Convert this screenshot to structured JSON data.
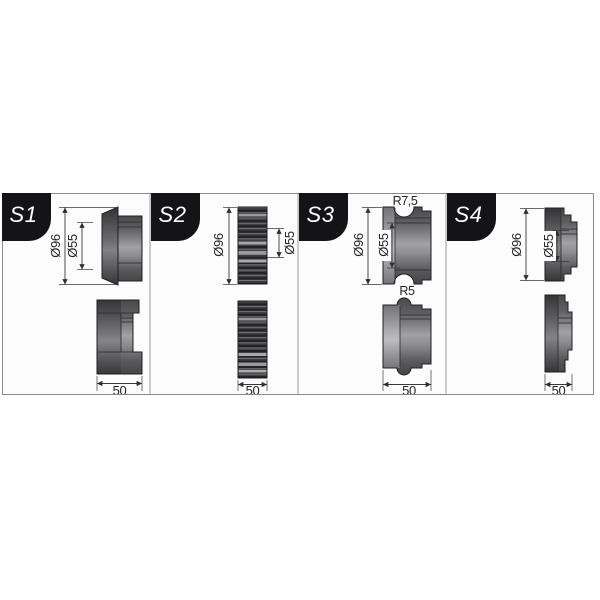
{
  "diagram_title": "roller-die-profiles",
  "panels": [
    {
      "id": "s1",
      "label": "S1",
      "dims": {
        "outer": "Ø96",
        "bore": "Ø55",
        "width": "50"
      }
    },
    {
      "id": "s2",
      "label": "S2",
      "dims": {
        "outer": "Ø96",
        "bore": "Ø55",
        "width": "50"
      }
    },
    {
      "id": "s3",
      "label": "S3",
      "dims": {
        "outer": "Ø96",
        "bore": "Ø55",
        "width": "50",
        "groove_radius": "R7,5",
        "bead_radius": "R5"
      }
    },
    {
      "id": "s4",
      "label": "S4",
      "dims": {
        "outer": "Ø96",
        "bore": "Ø55",
        "width": "50"
      }
    }
  ],
  "colors": {
    "badge_bg": "#141416",
    "badge_text": "#ffffff",
    "panel_bg": "#fcfcfc",
    "border": "#8a8a8c",
    "dimension_line": "#38383a",
    "metal_dark": "#3a3a3c",
    "metal_mid": "#6f6f71",
    "metal_light": "#a6a6a8"
  }
}
